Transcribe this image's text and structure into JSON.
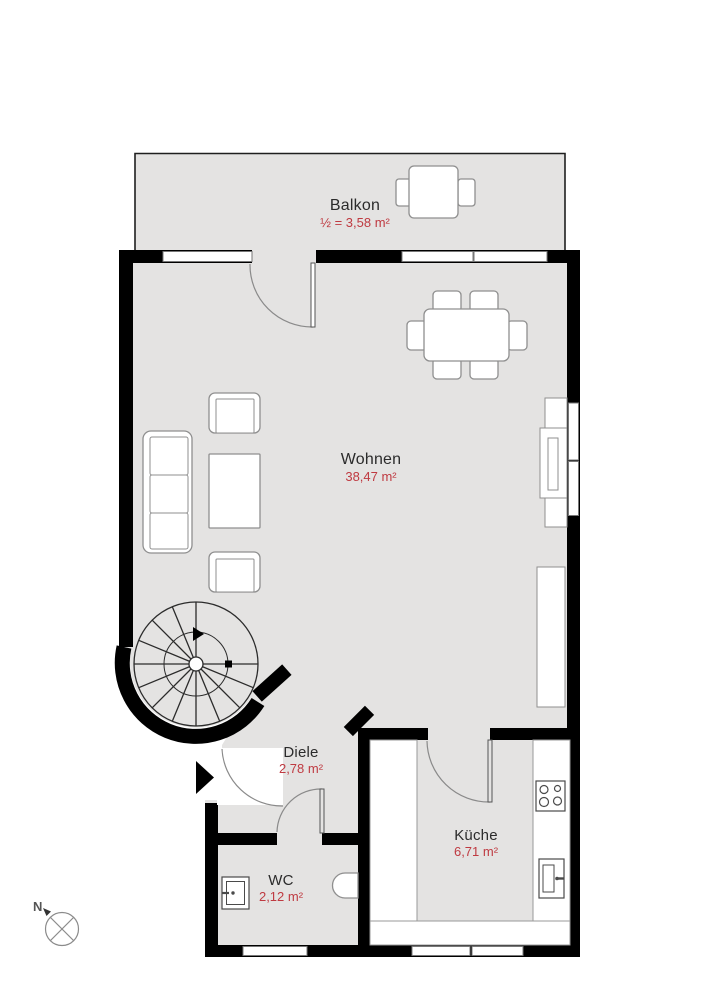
{
  "plan": {
    "title": "Wohnung Grundriss",
    "rooms": [
      {
        "id": "balkon",
        "name": "Balkon",
        "area": "½ = 3,58 m²"
      },
      {
        "id": "wohnen",
        "name": "Wohnen",
        "area": "38,47 m²"
      },
      {
        "id": "diele",
        "name": "Diele",
        "area": "2,78 m²"
      },
      {
        "id": "wc",
        "name": "WC",
        "area": "2,12 m²"
      },
      {
        "id": "kueche",
        "name": "Küche",
        "area": "6,71 m²"
      }
    ],
    "compass": {
      "label": "N"
    },
    "colors": {
      "floor": "#e4e3e2",
      "wall": "#000000",
      "room_text": "#2b2b2b",
      "area_text": "#bf3a41",
      "furniture_stroke": "#8f8f8f",
      "window_frame": "#777777"
    }
  }
}
